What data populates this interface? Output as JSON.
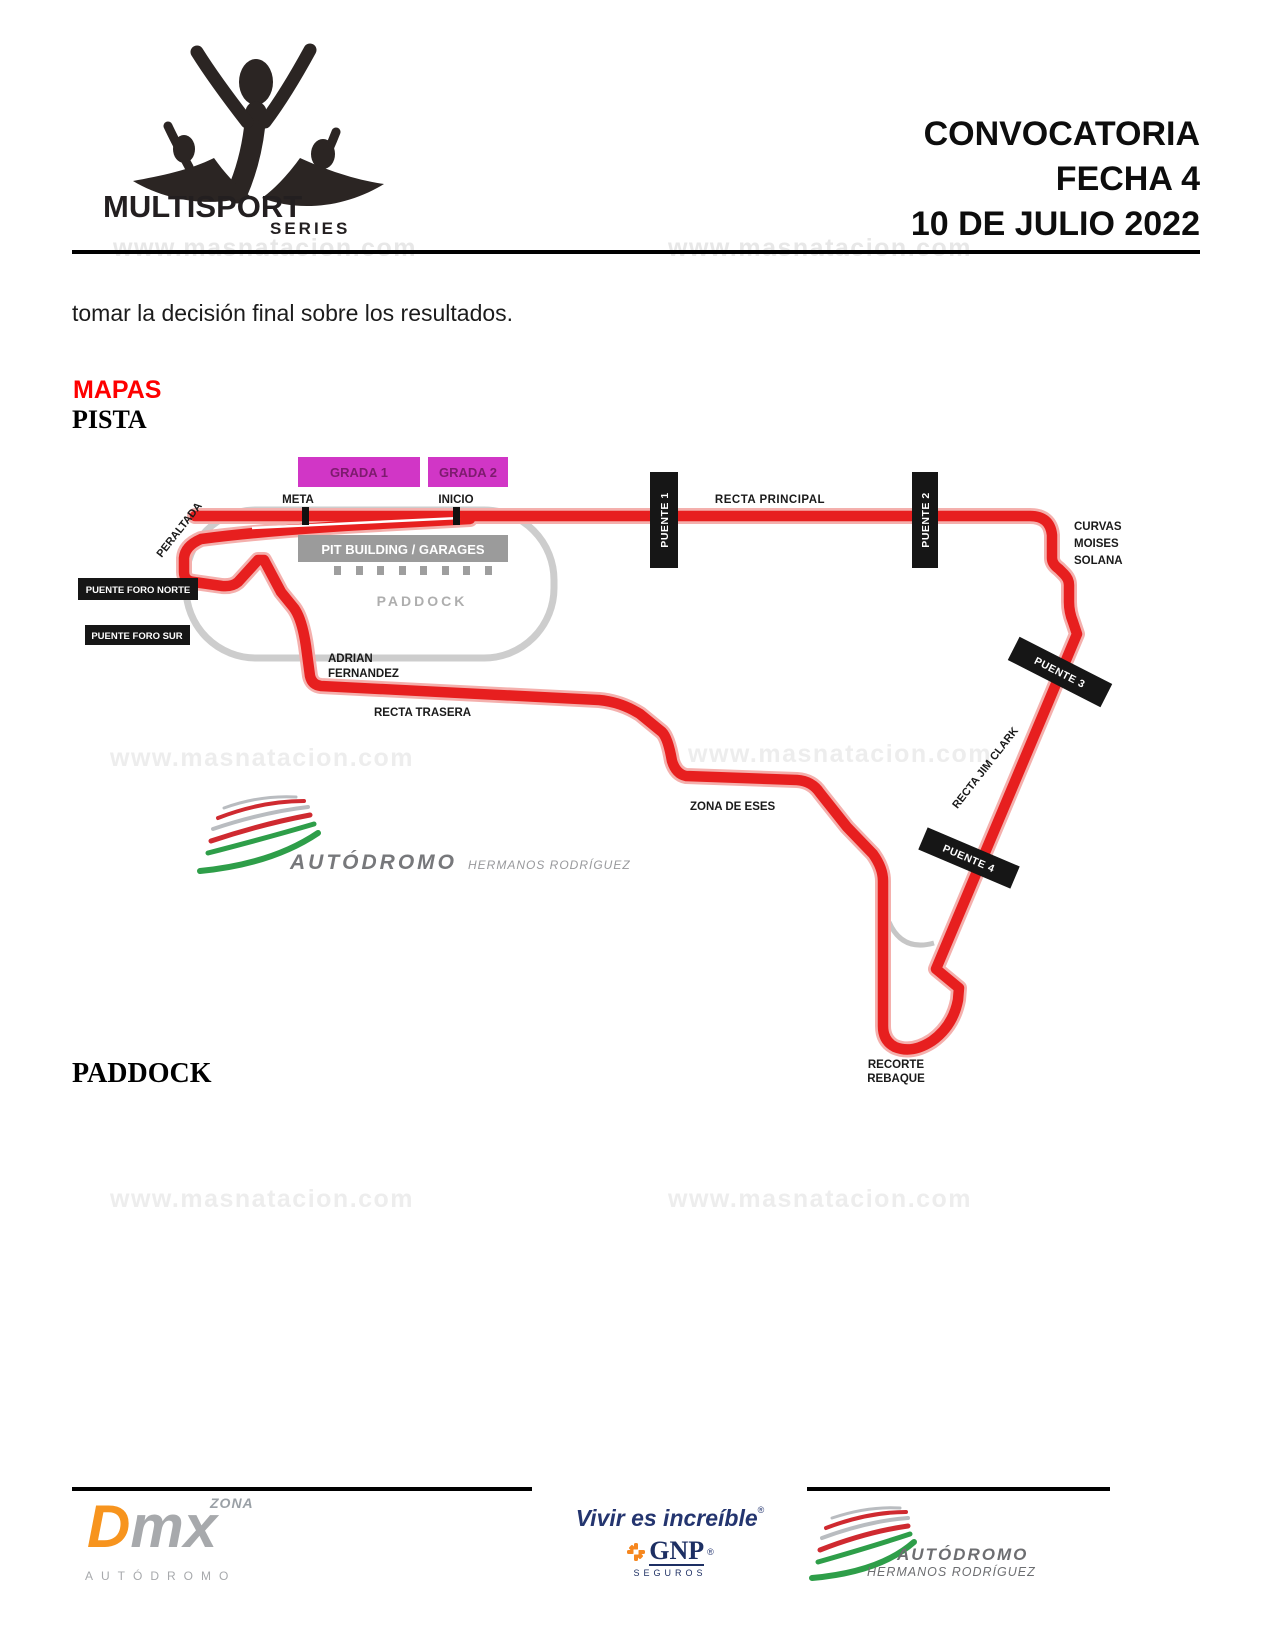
{
  "watermark": {
    "text": "www.masnatacion.com",
    "color": "#e7e7e7"
  },
  "logo": {
    "brand": "MULTISPORT",
    "series": "SERIES"
  },
  "header": {
    "line1": "CONVOCATORIA",
    "line2": "FECHA 4",
    "line3": "10 DE JULIO 2022"
  },
  "body": {
    "paragraph": "tomar la decisión final sobre los resultados."
  },
  "sections": {
    "mapas": "MAPAS",
    "pista": "PISTA",
    "paddock": "PADDOCK"
  },
  "map": {
    "labels": {
      "grada1": "GRADA 1",
      "grada2": "GRADA 2",
      "meta": "META",
      "inicio": "INICIO",
      "pit_building": "PIT BUILDING / GARAGES",
      "paddock": "PADDOCK",
      "peraltada": "PERALTADA",
      "puente_foro_norte": "PUENTE FORO NORTE",
      "puente_foro_sur": "PUENTE FORO SUR",
      "adrian_line1": "ADRIAN",
      "adrian_line2": "FERNANDEZ",
      "recta_trasera": "RECTA TRASERA",
      "puente1": "PUENTE 1",
      "recta_principal": "RECTA PRINCIPAL",
      "puente2": "PUENTE 2",
      "curvas_line1": "CURVAS",
      "curvas_line2": "MOISES",
      "curvas_line3": "SOLANA",
      "puente3": "PUENTE 3",
      "recta_jim_clark": "RECTA JIM CLARK",
      "puente4": "PUENTE 4",
      "zona_de_eses": "ZONA DE ESES",
      "recorte_line1": "RECORTE",
      "recorte_line2": "REBAQUE"
    },
    "logo": {
      "brand": "AUTÓDROMO",
      "sub": "HERMANOS RODRÍGUEZ"
    },
    "colors": {
      "track": "#e71f1f",
      "track_halo": "#f4b0ad",
      "grada_box": "#d136c6",
      "grada_text": "#7d1b6e",
      "bridge_box": "#161616",
      "pit_box": "#9b9b9b",
      "oval": "#cdcdcd",
      "mapas_heading": "#fe0000"
    }
  },
  "footer": {
    "dmx": {
      "zona": "ZONA",
      "d": "D",
      "mx": "mx",
      "caption": "AUTÓDROMO"
    },
    "gnp": {
      "tagline": "Vivir es increíble",
      "mark": "®",
      "brand": "GNP",
      "sub": "SEGUROS"
    },
    "ahr": {
      "brand": "AUTÓDROMO",
      "sub": "HERMANOS RODRÍGUEZ"
    }
  }
}
